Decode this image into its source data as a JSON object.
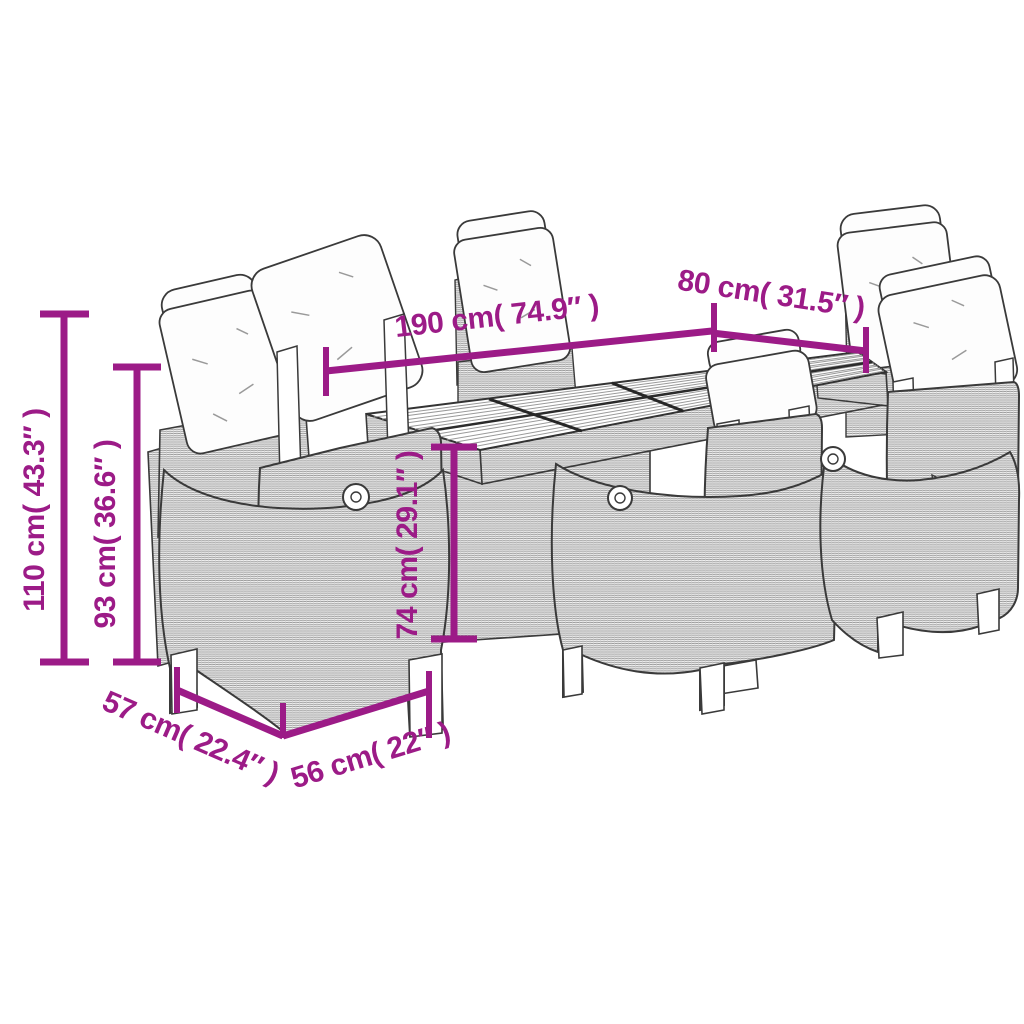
{
  "figure": {
    "description": "Line drawing of a 7-piece garden dining set: rectangular slatted-top table with six wicker reclining chairs with cushions",
    "background_color": "#ffffff",
    "line_color": "#3a3a3a",
    "accent_color": "#9c1b87"
  },
  "dimensions": {
    "table_length": "190 cm( 74.9″ )",
    "table_width": "80 cm( 31.5″ )",
    "height_total": "110 cm( 43.3″ )",
    "height_backrest": "93 cm( 36.6″ )",
    "height_table": "74 cm( 29.1″ )",
    "depth_seat": "57 cm( 22.4″ )",
    "width_seat": "56 cm( 22″ )"
  }
}
